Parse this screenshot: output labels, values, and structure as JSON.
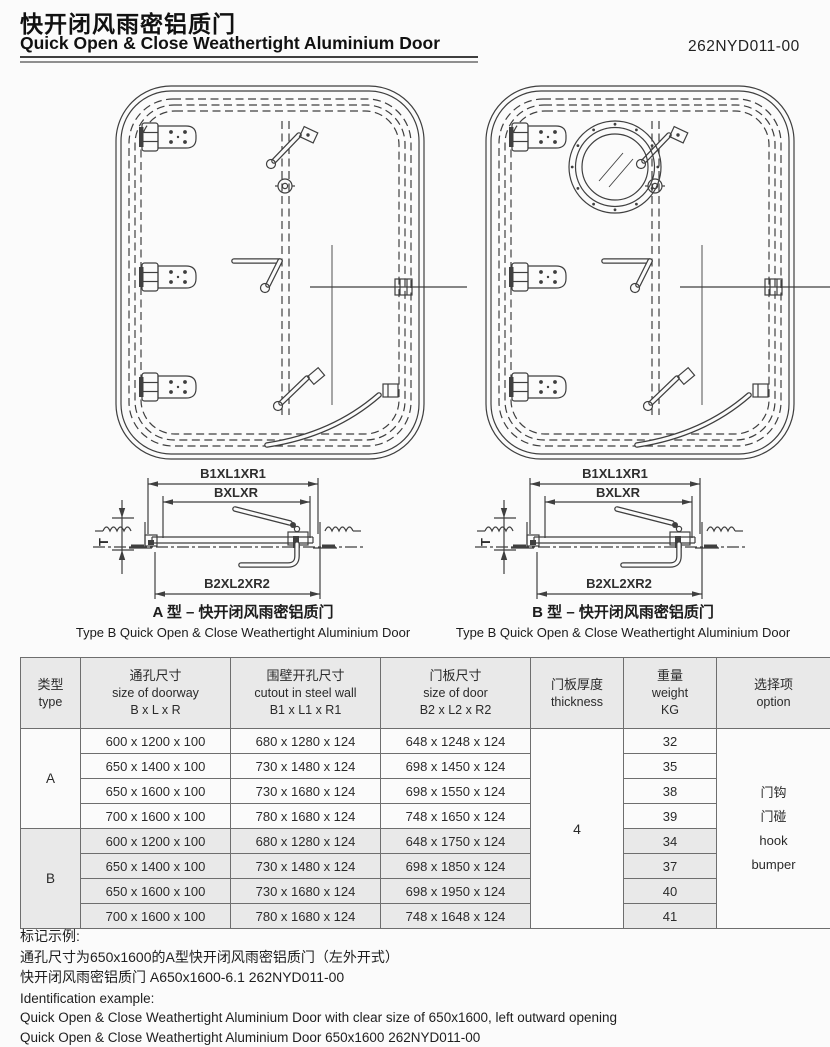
{
  "header": {
    "title_zh": "快开闭风雨密铝质门",
    "title_en": "Quick Open & Close Weathertight Aluminium Door",
    "doc_number": "262NYD011-00"
  },
  "drawings": {
    "type_a": {
      "caption_zh": "A 型 – 快开闭风雨密铝质门",
      "caption_en": "Type B Quick Open & Close Weathertight Aluminium Door"
    },
    "type_b": {
      "caption_zh": "B 型 – 快开闭风雨密铝质门",
      "caption_en": "Type B Quick Open & Close Weathertight Aluminium Door"
    },
    "section_labels": {
      "top": "B1XL1XR1",
      "middle": "BXLXR",
      "bottom": "B2XL2XR2",
      "thickness": "T"
    }
  },
  "table": {
    "headers": [
      {
        "zh": "类型",
        "en": "type"
      },
      {
        "zh": "通孔尺寸",
        "en": "size of doorway",
        "dim": "B x L x R"
      },
      {
        "zh": "围壁开孔尺寸",
        "en": "cutout in steel wall",
        "dim": "B1 x L1 x R1"
      },
      {
        "zh": "门板尺寸",
        "en": "size of door",
        "dim": "B2 x L2 x R2"
      },
      {
        "zh": "门板厚度",
        "en": "thickness"
      },
      {
        "zh": "重量",
        "en": "weight",
        "dim": "KG"
      },
      {
        "zh": "选择项",
        "en": "option"
      }
    ],
    "thickness_value": "4",
    "option_lines": [
      "门钩",
      "门碰",
      "hook",
      "bumper"
    ],
    "groups": [
      {
        "type": "A",
        "shaded": false,
        "rows": [
          {
            "doorway": "600 x 1200 x 100",
            "cutout": "680 x 1280 x 124",
            "door": "648 x 1248 x 124",
            "weight": "32"
          },
          {
            "doorway": "650 x 1400 x 100",
            "cutout": "730 x 1480 x 124",
            "door": "698 x 1450 x 124",
            "weight": "35"
          },
          {
            "doorway": "650 x 1600 x 100",
            "cutout": "730 x 1680 x 124",
            "door": "698 x 1550 x 124",
            "weight": "38"
          },
          {
            "doorway": "700 x 1600 x 100",
            "cutout": "780 x 1680 x 124",
            "door": "748 x 1650 x 124",
            "weight": "39"
          }
        ]
      },
      {
        "type": "B",
        "shaded": true,
        "rows": [
          {
            "doorway": "600 x 1200 x 100",
            "cutout": "680 x 1280 x 124",
            "door": "648 x 1750 x 124",
            "weight": "34"
          },
          {
            "doorway": "650 x 1400 x 100",
            "cutout": "730 x 1480 x 124",
            "door": "698 x 1850 x 124",
            "weight": "37"
          },
          {
            "doorway": "650 x 1600 x 100",
            "cutout": "730 x 1680 x 124",
            "door": "698 x 1950 x 124",
            "weight": "40"
          },
          {
            "doorway": "700 x 1600 x 100",
            "cutout": "780 x 1680 x 124",
            "door": "748 x 1648 x 124",
            "weight": "41"
          }
        ]
      }
    ]
  },
  "footer": {
    "label_zh": "标记示例:",
    "line1_zh": "通孔尺寸为650x1600的A型快开闭风雨密铝质门（左外开式）",
    "line2_zh": "快开闭风雨密铝质门 A650x1600-6.1 262NYD011-00",
    "label_en": "Identification example:",
    "line1_en": "Quick Open & Close Weathertight Aluminium Door with clear size of 650x1600, left outward opening",
    "line2_en": "Quick Open & Close Weathertight Aluminium Door 650x1600 262NYD011-00"
  },
  "colors": {
    "ink": "#3f3f3f",
    "row_shading": "#e9e9e9"
  }
}
